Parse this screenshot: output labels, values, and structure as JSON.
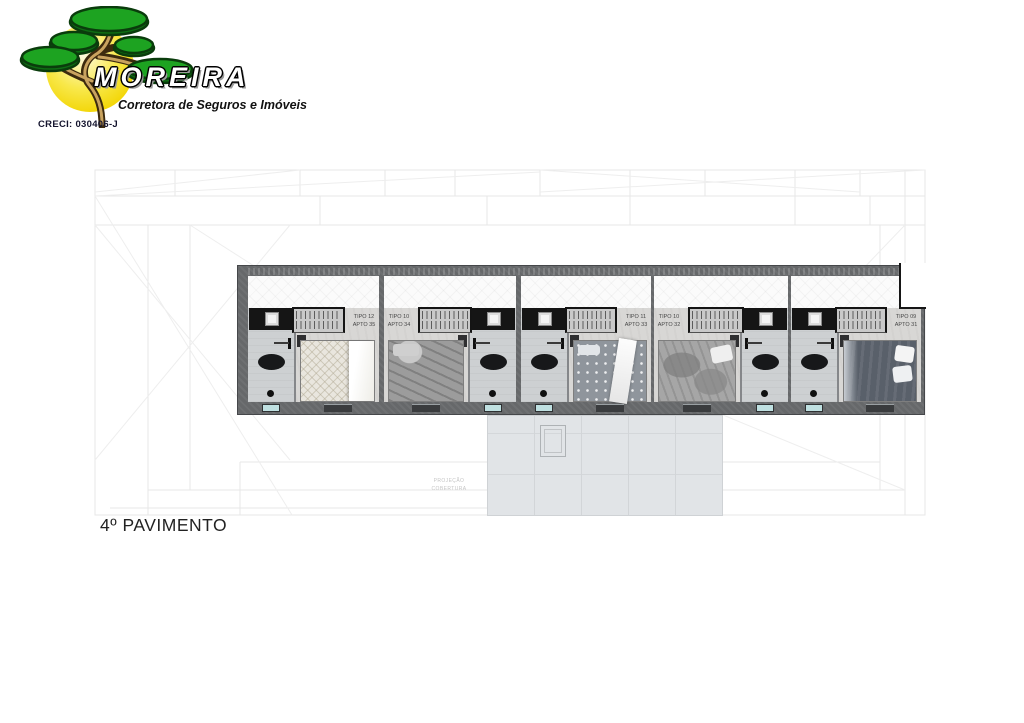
{
  "logo": {
    "brand": "MOREIRA",
    "tagline": "Corretora de Seguros e Imóveis",
    "creci": "CRECI: 030406-J"
  },
  "floor_label": "4º PAVIMENTO",
  "plan": {
    "faint_note_line1": "PROJEÇÃO",
    "faint_note_line2": "COBERTURA",
    "units": [
      {
        "tipo": "TIPO 12",
        "apto": "APTO 35",
        "variant": "bath-left",
        "bed_style": "cream"
      },
      {
        "tipo": "TIPO 10",
        "apto": "APTO 34",
        "variant": "bath-right",
        "bed_style": "drape"
      },
      {
        "tipo": "TIPO 11",
        "apto": "APTO 33",
        "variant": "bath-left",
        "bed_style": "dot"
      },
      {
        "tipo": "TIPO 10",
        "apto": "APTO 32",
        "variant": "bath-right",
        "bed_style": "crumple"
      },
      {
        "tipo": "TIPO 09",
        "apto": "APTO 31",
        "variant": "bath-left",
        "bed_style": "charcoal"
      }
    ],
    "colors": {
      "wall": "#66686a",
      "bath-floor": "#cdd0d2",
      "bedroom-floor": "#d8d7d5",
      "balcony": "#fbfbfb",
      "terrace": "#e1e4e7",
      "window-glass": "#bfe0e1",
      "logo-sun": "#f2d400",
      "logo-green": "#1da321"
    }
  }
}
